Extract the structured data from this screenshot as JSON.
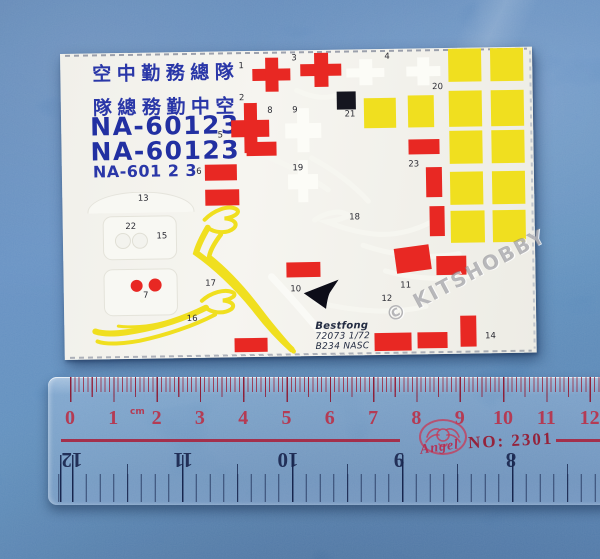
{
  "watermark": "© KITSHOBBY",
  "sheet": {
    "title_row1": "空中勤務總隊",
    "title_row2": "隊總務勤中空",
    "serial_large": "NA-60123",
    "serial_small": "NA-601 2 3",
    "maker_line1": "Bestfong",
    "maker_line2": "72073 1/72",
    "maker_line3": "B234 NASC",
    "markers": [
      {
        "n": "1",
        "x": 181,
        "y": 15
      },
      {
        "n": "2",
        "x": 181,
        "y": 47
      },
      {
        "n": "3",
        "x": 234,
        "y": 8
      },
      {
        "n": "4",
        "x": 327,
        "y": 8
      },
      {
        "n": "5",
        "x": 159,
        "y": 84
      },
      {
        "n": "6",
        "x": 137,
        "y": 120
      },
      {
        "n": "7",
        "x": 82,
        "y": 243
      },
      {
        "n": "8",
        "x": 209,
        "y": 60
      },
      {
        "n": "9",
        "x": 234,
        "y": 60
      },
      {
        "n": "10",
        "x": 232,
        "y": 239
      },
      {
        "n": "11",
        "x": 342,
        "y": 237
      },
      {
        "n": "12",
        "x": 323,
        "y": 250
      },
      {
        "n": "13",
        "x": 81,
        "y": 146
      },
      {
        "n": "14",
        "x": 426,
        "y": 289
      },
      {
        "n": "15",
        "x": 99,
        "y": 184
      },
      {
        "n": "16",
        "x": 128,
        "y": 267
      },
      {
        "n": "17",
        "x": 147,
        "y": 232
      },
      {
        "n": "18",
        "x": 292,
        "y": 168
      },
      {
        "n": "19",
        "x": 236,
        "y": 118
      },
      {
        "n": "20",
        "x": 377,
        "y": 39
      },
      {
        "n": "21",
        "x": 289,
        "y": 65
      },
      {
        "n": "22",
        "x": 68,
        "y": 174
      },
      {
        "n": "23",
        "x": 352,
        "y": 116
      }
    ],
    "shapes": [
      {
        "t": "arc",
        "x": 25,
        "y": 139,
        "w": 105,
        "h": 20
      },
      {
        "t": "panel",
        "x": 40,
        "y": 163,
        "w": 72,
        "h": 42
      },
      {
        "t": "panel",
        "x": 40,
        "y": 216,
        "w": 72,
        "h": 45
      },
      {
        "t": "hole",
        "x": 52,
        "y": 180,
        "d": 14
      },
      {
        "t": "hole",
        "x": 69,
        "y": 180,
        "d": 14
      },
      {
        "t": "cross",
        "c": "white",
        "x": 286,
        "y": 10,
        "w": 38,
        "h": 26
      },
      {
        "t": "cross",
        "c": "white",
        "x": 346,
        "y": 9,
        "w": 34,
        "h": 28
      },
      {
        "t": "cross",
        "c": "white",
        "x": 224,
        "y": 58,
        "w": 36,
        "h": 44
      },
      {
        "t": "cross",
        "c": "white",
        "x": 226,
        "y": 110,
        "w": 30,
        "h": 42
      },
      {
        "t": "cross",
        "c": "red",
        "x": 192,
        "y": 7,
        "w": 38,
        "h": 34
      },
      {
        "t": "cross",
        "c": "red",
        "x": 240,
        "y": 3,
        "w": 41,
        "h": 34
      },
      {
        "t": "cross",
        "c": "red",
        "x": 170,
        "y": 52,
        "w": 38,
        "h": 50
      },
      {
        "t": "sq",
        "c": "yellow",
        "x": 388,
        "y": 1,
        "w": 33,
        "h": 33
      },
      {
        "t": "sq",
        "c": "yellow",
        "x": 430,
        "y": 1,
        "w": 33,
        "h": 33
      },
      {
        "t": "sq",
        "c": "yellow",
        "x": 388,
        "y": 43,
        "w": 33,
        "h": 36
      },
      {
        "t": "sq",
        "c": "yellow",
        "x": 430,
        "y": 43,
        "w": 33,
        "h": 36
      },
      {
        "t": "sq",
        "c": "yellow",
        "x": 388,
        "y": 83,
        "w": 33,
        "h": 33
      },
      {
        "t": "sq",
        "c": "yellow",
        "x": 430,
        "y": 83,
        "w": 33,
        "h": 33
      },
      {
        "t": "sq",
        "c": "yellow",
        "x": 388,
        "y": 124,
        "w": 33,
        "h": 33
      },
      {
        "t": "sq",
        "c": "yellow",
        "x": 430,
        "y": 124,
        "w": 33,
        "h": 33
      },
      {
        "t": "sq",
        "c": "yellow",
        "x": 388,
        "y": 163,
        "w": 34,
        "h": 32
      },
      {
        "t": "sq",
        "c": "yellow",
        "x": 430,
        "y": 163,
        "w": 33,
        "h": 32
      },
      {
        "t": "sq",
        "c": "yellow",
        "x": 303,
        "y": 49,
        "w": 32,
        "h": 30
      },
      {
        "t": "sq",
        "c": "yellow",
        "x": 347,
        "y": 47,
        "w": 26,
        "h": 32
      },
      {
        "t": "sq",
        "c": "black",
        "x": 276,
        "y": 42,
        "w": 19,
        "h": 18
      },
      {
        "t": "rect",
        "c": "red",
        "x": 185,
        "y": 91,
        "w": 30,
        "h": 14
      },
      {
        "t": "rect",
        "c": "red",
        "x": 143,
        "y": 113,
        "w": 32,
        "h": 16
      },
      {
        "t": "rect",
        "c": "red",
        "x": 143,
        "y": 138,
        "w": 34,
        "h": 16
      },
      {
        "t": "rect",
        "c": "red",
        "x": 347,
        "y": 91,
        "w": 31,
        "h": 15
      },
      {
        "t": "rect",
        "c": "red",
        "x": 364,
        "y": 119,
        "w": 16,
        "h": 30
      },
      {
        "t": "rect",
        "c": "red",
        "x": 367,
        "y": 158,
        "w": 15,
        "h": 30
      },
      {
        "t": "rect",
        "c": "red",
        "x": 332,
        "y": 198,
        "w": 35,
        "h": 25,
        "r": -7
      },
      {
        "t": "rect",
        "c": "red",
        "x": 373,
        "y": 208,
        "w": 30,
        "h": 19
      },
      {
        "t": "rect",
        "c": "red",
        "x": 223,
        "y": 212,
        "w": 34,
        "h": 15
      },
      {
        "t": "rect",
        "c": "red",
        "x": 396,
        "y": 268,
        "w": 16,
        "h": 31
      },
      {
        "t": "rect",
        "c": "red",
        "x": 310,
        "y": 284,
        "w": 37,
        "h": 18
      },
      {
        "t": "rect",
        "c": "red",
        "x": 353,
        "y": 284,
        "w": 30,
        "h": 16
      },
      {
        "t": "rect",
        "c": "red",
        "x": 170,
        "y": 287,
        "w": 33,
        "h": 14
      },
      {
        "t": "dot",
        "c": "red",
        "x": 67,
        "y": 227,
        "d": 12
      },
      {
        "t": "dot",
        "c": "red",
        "x": 85,
        "y": 226,
        "d": 13
      }
    ]
  },
  "ruler": {
    "cm_numbers": [
      "0",
      "1",
      "2",
      "3",
      "4",
      "5",
      "6",
      "7",
      "8",
      "9",
      "10",
      "11",
      "12"
    ],
    "cm_unit": "cm",
    "inch_numbers": [
      "12",
      "11",
      "10",
      "9",
      "8"
    ],
    "brand": "Angel",
    "model_no": "NO: 2301"
  },
  "colors": {
    "decal_red": "#e82823",
    "decal_yellow": "#f0df1f",
    "decal_blue": "#2a37a8",
    "sheet_white": "#f2f1eb",
    "decal_black": "#15151f",
    "ruler_cm_red": "#b43b54",
    "ruler_inch_blue": "#223058",
    "background_blue": "#4479b4"
  }
}
